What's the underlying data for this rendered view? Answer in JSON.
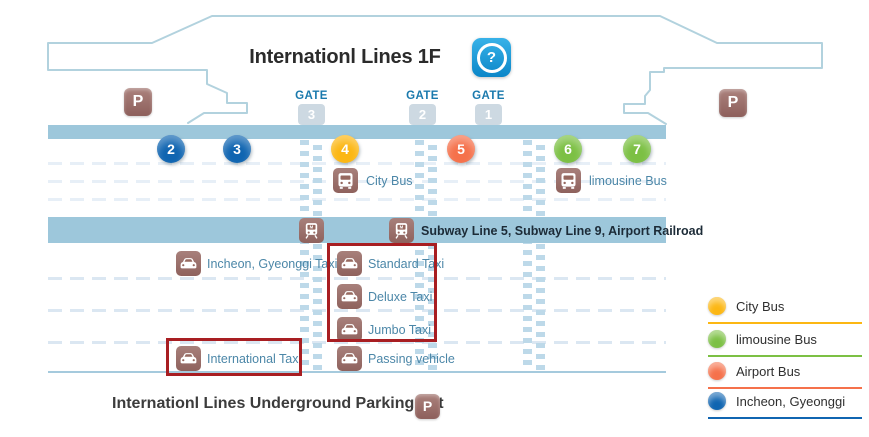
{
  "title": "Internationl Lines 1F",
  "help": {
    "symbol": "?"
  },
  "parking": {
    "symbol": "P"
  },
  "gates": [
    {
      "label": "GATE",
      "number": "3"
    },
    {
      "label": "GATE",
      "number": "2"
    },
    {
      "label": "GATE",
      "number": "1"
    }
  ],
  "platform_numbers": [
    {
      "number": "2",
      "color": "#1065b1"
    },
    {
      "number": "3",
      "color": "#1065b1"
    },
    {
      "number": "4",
      "color": "#fcb713"
    },
    {
      "number": "5",
      "color": "#f5714b"
    },
    {
      "number": "6",
      "color": "#7cc044"
    },
    {
      "number": "7",
      "color": "#7cc044"
    }
  ],
  "labels": {
    "city_bus": "City Bus",
    "limousine_bus": "limousine Bus",
    "subway": "Subway Line 5, Subway Line 9, Airport Railroad",
    "incheon_taxi": "Incheon, Gyeonggi Taxi",
    "standard_taxi": "Standard Taxi",
    "deluxe_taxi": "Deluxe Taxi",
    "jumbo_taxi": "Jumbo Taxi",
    "international_taxi": "International Taxi",
    "passing_vehicle": "Passing vehicle"
  },
  "legend": [
    {
      "label": "City Bus",
      "color": "#fcb713"
    },
    {
      "label": "limousine Bus",
      "color": "#7cc044"
    },
    {
      "label": "Airport Bus",
      "color": "#f5714b"
    },
    {
      "label": "Incheon, Gyeonggi",
      "color": "#1065b1"
    }
  ],
  "footer": {
    "caption": "Internationl Lines Underground Parking Lot"
  },
  "colors": {
    "road": "#9dc7db",
    "crosswalk_stripe": "#bdd9e9",
    "outline": "#b2d2de",
    "red_box": "#a81e22",
    "map_label_blue": "#4c87a8",
    "gate_blue": "#1b7aad",
    "icon_brown": "#9a6e69"
  }
}
